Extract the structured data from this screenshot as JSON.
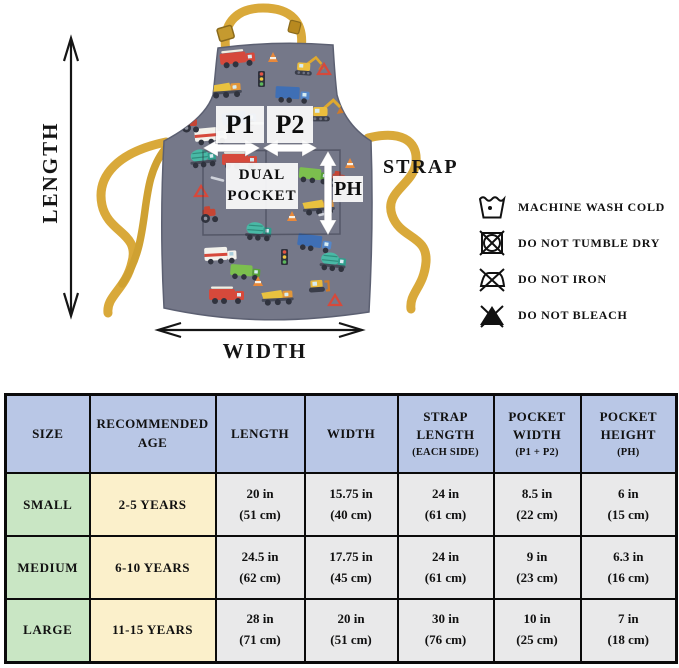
{
  "diagram": {
    "length_label": "LENGTH",
    "width_label": "WIDTH",
    "strap_label": "STRAP",
    "p1_label": "P1",
    "p2_label": "P2",
    "ph_label": "PH",
    "dual_pocket": [
      "DUAL",
      "POCKET"
    ],
    "colors": {
      "apron_fabric": "#757889",
      "strap_yellow": "#d9a93a",
      "annotation_box": "#f9f9f9",
      "arrow_white": "#ffffff",
      "arrow_black": "#151515"
    }
  },
  "care": {
    "items": [
      {
        "icon": "machine-wash-cold-icon",
        "label": "MACHINE WASH COLD"
      },
      {
        "icon": "do-not-tumble-dry-icon",
        "label": "DO NOT TUMBLE DRY"
      },
      {
        "icon": "do-not-iron-icon",
        "label": "DO NOT IRON"
      },
      {
        "icon": "do-not-bleach-icon",
        "label": "DO NOT BLEACH"
      }
    ]
  },
  "size_chart": {
    "colors": {
      "header_bg": "#b9c7e6",
      "size_bg": "#c9e6c4",
      "age_bg": "#fbf0cb",
      "value_bg": "#e9e9ea",
      "border": "#0b0b0b"
    },
    "headers": [
      {
        "lines": [
          "SIZE"
        ]
      },
      {
        "lines": [
          "RECOMMENDED",
          "AGE"
        ]
      },
      {
        "lines": [
          "LENGTH"
        ]
      },
      {
        "lines": [
          "WIDTH"
        ]
      },
      {
        "lines": [
          "STRAP",
          "LENGTH"
        ],
        "sub": "(EACH SIDE)"
      },
      {
        "lines": [
          "POCKET",
          "WIDTH"
        ],
        "sub": "(P1 + P2)"
      },
      {
        "lines": [
          "POCKET",
          "HEIGHT"
        ],
        "sub": "(PH)"
      }
    ],
    "rows": [
      {
        "size": "SMALL",
        "age": "2-5 YEARS",
        "values": [
          [
            "20 in",
            "(51 cm)"
          ],
          [
            "15.75 in",
            "(40 cm)"
          ],
          [
            "24 in",
            "(61 cm)"
          ],
          [
            "8.5 in",
            "(22 cm)"
          ],
          [
            "6 in",
            "(15 cm)"
          ]
        ]
      },
      {
        "size": "MEDIUM",
        "age": "6-10 YEARS",
        "values": [
          [
            "24.5 in",
            "(62 cm)"
          ],
          [
            "17.75 in",
            "(45 cm)"
          ],
          [
            "24 in",
            "(61 cm)"
          ],
          [
            "9 in",
            "(23 cm)"
          ],
          [
            "6.3 in",
            "(16 cm)"
          ]
        ]
      },
      {
        "size": "LARGE",
        "age": "11-15 YEARS",
        "values": [
          [
            "28 in",
            "(71 cm)"
          ],
          [
            "20 in",
            "(51 cm)"
          ],
          [
            "30 in",
            "(76 cm)"
          ],
          [
            "10 in",
            "(25 cm)"
          ],
          [
            "7 in",
            "(18 cm)"
          ]
        ]
      }
    ]
  }
}
